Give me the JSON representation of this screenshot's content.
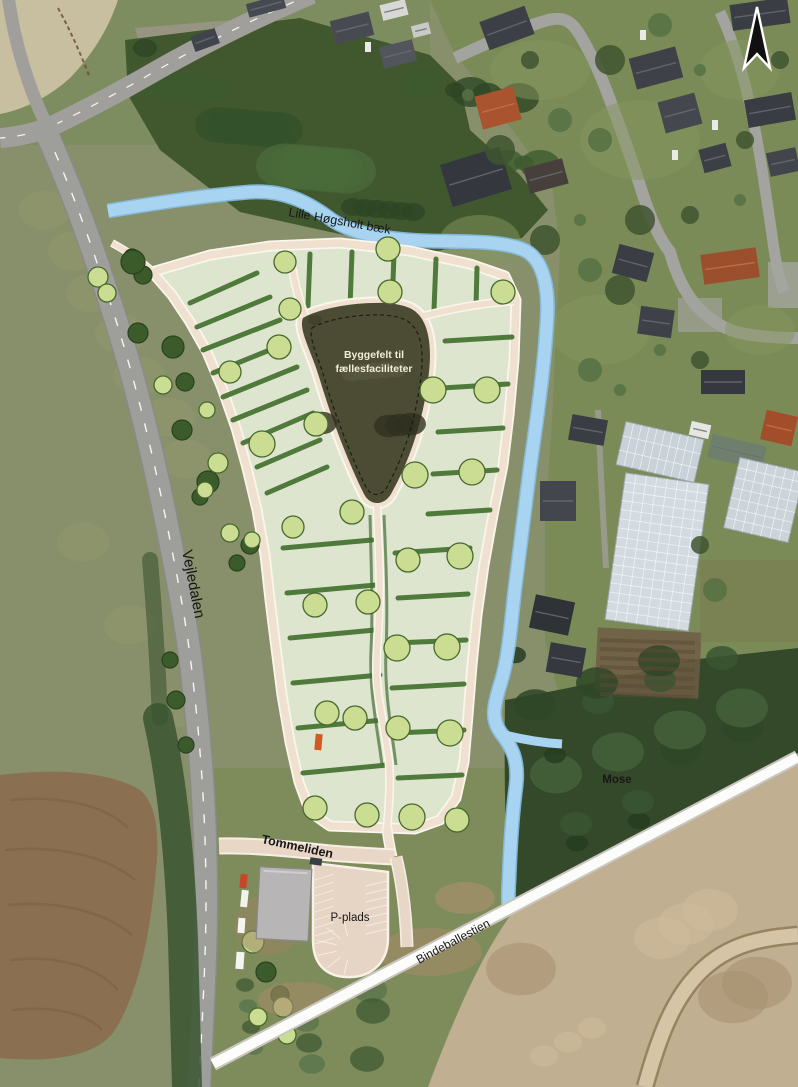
{
  "labels": {
    "stream": "Lille Høgsholt bæk",
    "building_field_line1": "Byggefelt til",
    "building_field_line2": "fællesfaciliteter",
    "road_vejledalen": "Vejledalen",
    "road_tommeliden": "Tommeliden",
    "parking": "P-plads",
    "path_bindeballestien": "Bindeballestien",
    "bog": "Mose"
  },
  "icons": {
    "north_arrow": "north-arrow-icon"
  },
  "colors": {
    "stream_blue": "#a8d4f1",
    "stream_edge": "#86bfe4",
    "parcel_green": "#dde5cf",
    "hedge_green": "#4f7a3b",
    "tree_green": "#cbdd92",
    "tree_outline": "#47682c",
    "dark_tree": "#3b5b2b",
    "dark_tree_outline": "#2a421f",
    "path_beige": "#efe0d0",
    "path_casing": "#fbf6ec",
    "building_field_dark": "#4b4c33",
    "label_dark": "#171717",
    "label_light": "#f2ecd9",
    "sand": "#c0af90",
    "road_grey": "#9e9e9a",
    "lot_beige": "#e6d4c4",
    "plan_building_grey": "#b7b5b6",
    "white_path": "#fcfcfa",
    "forest_dark": "#34492a",
    "woods_dark": "#41582f",
    "meadow": "#87906a",
    "lawn": "#7b8b57",
    "field_brown": "#8a6f50",
    "dry_field": "#c7bf9f"
  }
}
